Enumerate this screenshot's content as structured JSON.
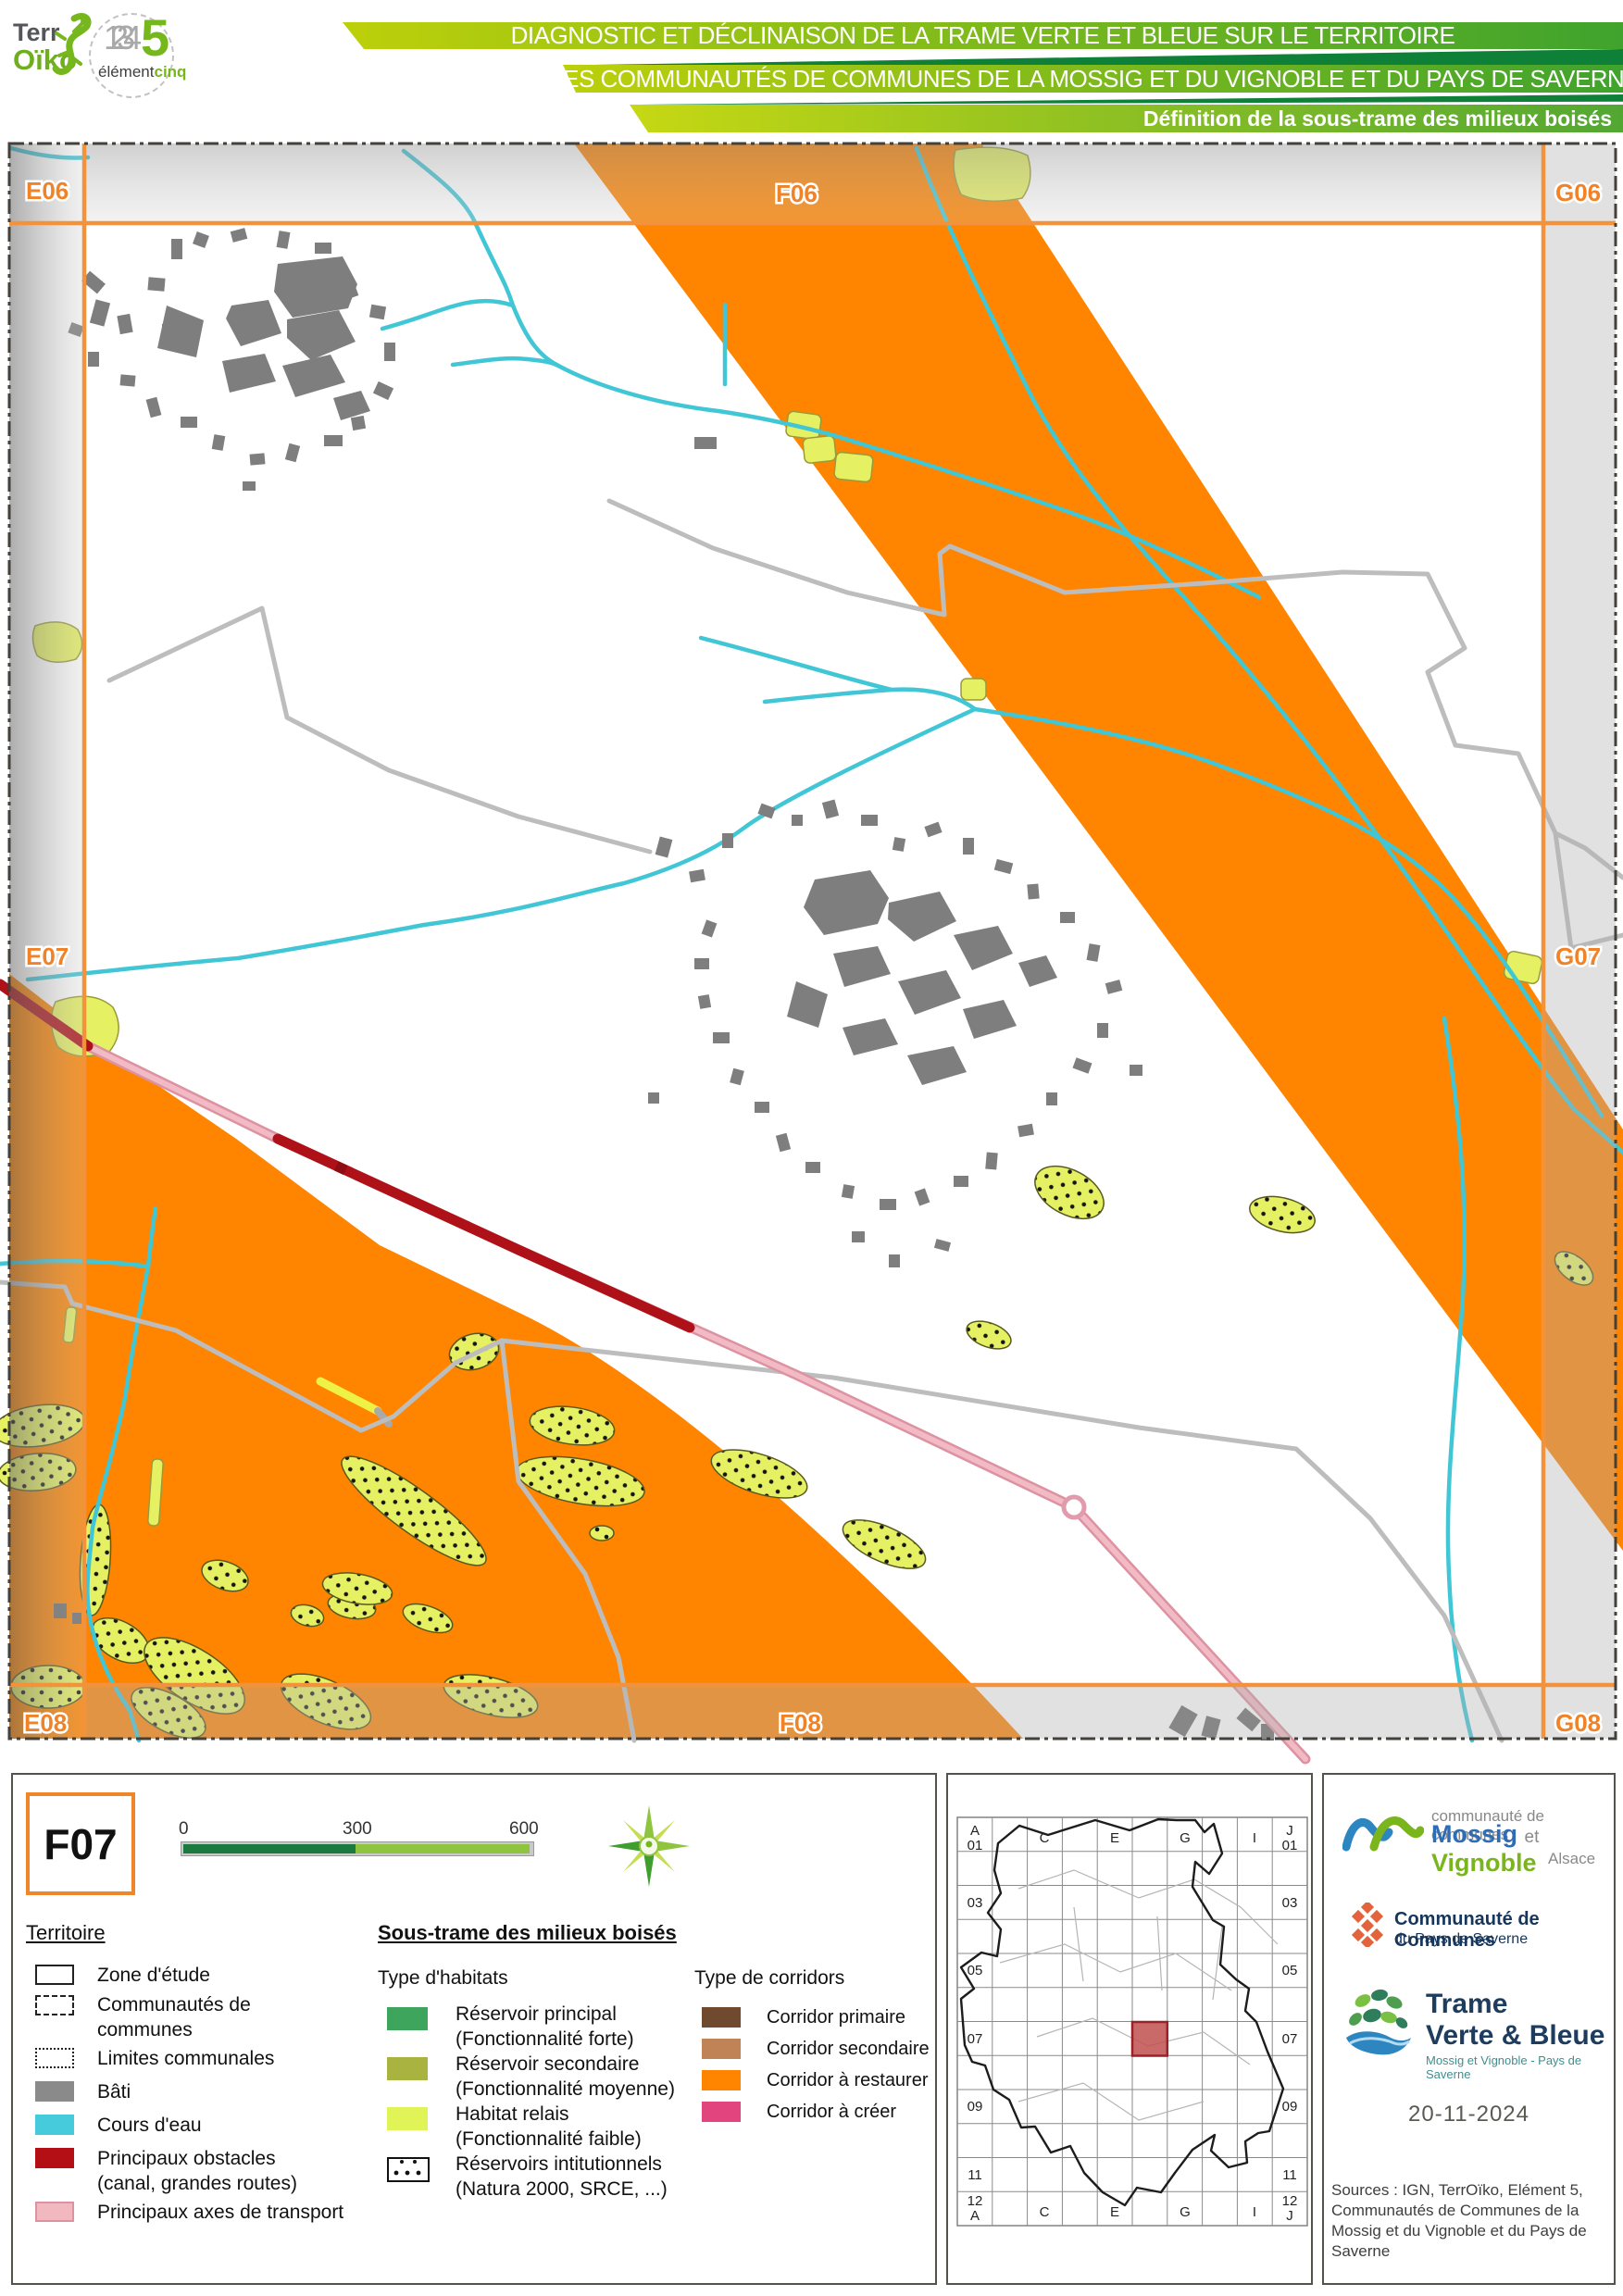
{
  "header": {
    "title_line1": "DIAGNOSTIC ET DÉCLINAISON DE LA TRAME VERTE ET BLEUE SUR LE TERRITOIRE",
    "title_line2": "DES COMMUNAUTÉS DE COMMUNES DE LA MOSSIG ET DU VIGNOBLE ET DU PAYS DE SAVERNE",
    "subtitle": "Définition de la sous-trame des milieux boisés",
    "logo_terroiko": {
      "part1": "Terr",
      "part2": "Oïko"
    },
    "logo_element": {
      "digits": "1234",
      "five": "5",
      "name1": "élément",
      "name2": "cinq"
    }
  },
  "map": {
    "grid_labels": {
      "e06": "E06",
      "f06": "F06",
      "g06": "G06",
      "e07": "E07",
      "g07": "G07",
      "e08": "E08",
      "f08": "F08",
      "g08": "G08"
    },
    "colors": {
      "corridor_restore": "#ff8400",
      "water": "#41c6d6",
      "built": "#7e7e7e",
      "obstacle": "#ae1117",
      "transport": "#f2bac4",
      "habitat": "#e5f163",
      "frame": "#f2923a"
    }
  },
  "legend": {
    "tile_label": "F07",
    "scalebar": {
      "start": "0",
      "mid": "300",
      "end": "600 m"
    },
    "compass_icon": "compass-rose-icon",
    "territoire": {
      "heading": "Territoire",
      "items": [
        {
          "label": "Zone d'étude",
          "sub": ""
        },
        {
          "label": "Communautés de",
          "sub": "communes"
        },
        {
          "label": "Limites communales",
          "sub": ""
        },
        {
          "label": "Bâti",
          "sub": ""
        },
        {
          "label": "Cours d'eau",
          "sub": ""
        },
        {
          "label": "Principaux obstacles",
          "sub": "(canal, grandes routes)"
        },
        {
          "label": "Principaux axes de transport",
          "sub": ""
        }
      ]
    },
    "soustrame": {
      "heading": "Sous-trame des milieux boisés",
      "habitats_heading": "Type d'habitats",
      "habitats": [
        {
          "label": "Réservoir principal",
          "sub": "(Fonctionnalité forte)",
          "color": "#3da65c"
        },
        {
          "label": "Réservoir secondaire",
          "sub": "(Fonctionnalité moyenne)",
          "color": "#a9b33f"
        },
        {
          "label": "Habitat relais",
          "sub": "(Fonctionnalité faible)",
          "color": "#e0f457"
        },
        {
          "label": "Réservoirs intitutionnels",
          "sub": "(Natura 2000, SRCE, ...)",
          "color": "dotted"
        }
      ],
      "corridors_heading": "Type de corridors",
      "corridors": [
        {
          "label": "Corridor primaire",
          "color": "#6f4a2e"
        },
        {
          "label": "Corridor secondaire",
          "color": "#c08355"
        },
        {
          "label": "Corridor à restaurer",
          "color": "#ff8400"
        },
        {
          "label": "Corridor à créer",
          "color": "#e2447d"
        }
      ]
    }
  },
  "inset": {
    "corner_tl": [
      "A",
      "01"
    ],
    "corner_tr": [
      "J",
      "01"
    ],
    "corner_bl": [
      "12",
      "A"
    ],
    "corner_br": [
      "12",
      "J"
    ],
    "cols": [
      "C",
      "E",
      "G",
      "I"
    ],
    "rows": [
      "03",
      "05",
      "07",
      "09",
      "11"
    ],
    "highlight_cell": "F07"
  },
  "credits": {
    "mossig": {
      "small": "communauté de communes",
      "name1": "Mossig",
      "et": "et",
      "name2": "Vignoble",
      "region": "Alsace"
    },
    "saverne": {
      "line1": "Communauté de Communes",
      "line2": "du Pays de Saverne"
    },
    "tvb": {
      "line1": "Trame",
      "line2": "Verte & Bleue",
      "sub": "Mossig et Vignoble - Pays de Saverne"
    },
    "date": "20-11-2024",
    "sources": "Sources : IGN, TerrOïko, Elément 5, Communautés de Communes de la Mossig et du Vignoble et du Pays de Saverne"
  }
}
